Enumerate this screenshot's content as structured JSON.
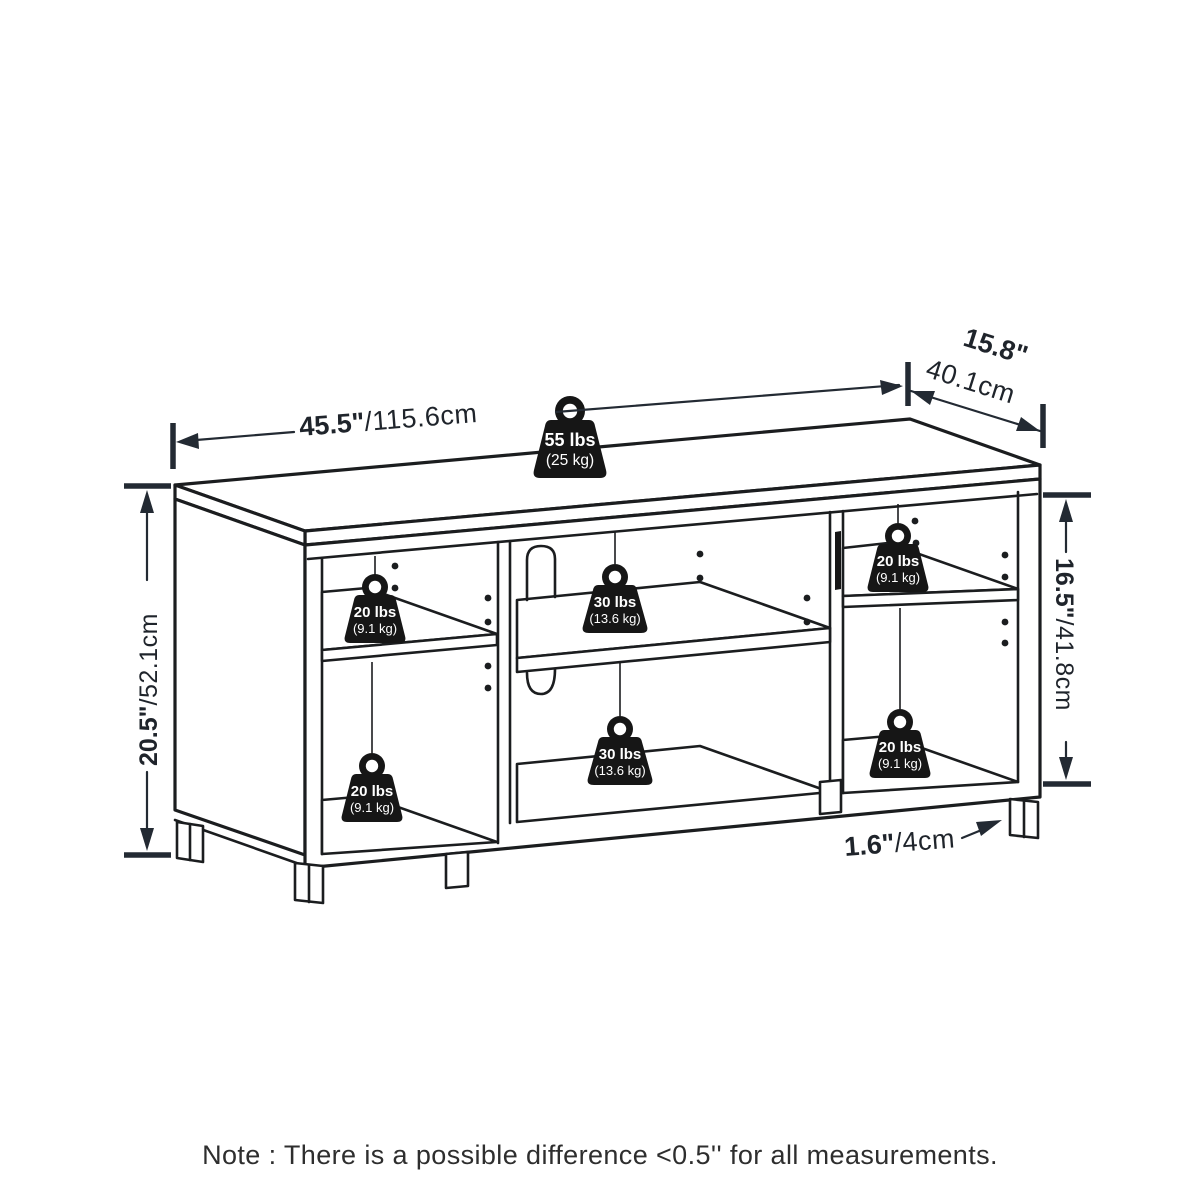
{
  "dimensions": {
    "width": {
      "in": "45.5\"",
      "cm": "/115.6cm"
    },
    "depth": {
      "in": "15.8\"",
      "cm": "40.1cm"
    },
    "height": {
      "in": "20.5\"",
      "cm": "/52.1cm"
    },
    "shelf": {
      "in": "16.5\"",
      "cm": "/41.8cm"
    },
    "leg": {
      "in": "1.6\"",
      "cm": "/4cm"
    }
  },
  "weights": {
    "top": {
      "lbs": "55 lbs",
      "kg": "(25 kg)"
    },
    "shelf30": {
      "lbs": "30 lbs",
      "kg": "(13.6 kg)"
    },
    "shelf20": {
      "lbs": "20 lbs",
      "kg": "(9.1 kg)"
    }
  },
  "note": {
    "text": "Note : There is a possible difference <0.5'' for all measurements."
  },
  "colors": {
    "line": "#1b1d1f",
    "dimension": "#232a33",
    "weight_fill": "#161616",
    "weight_text": "#ffffff",
    "note_text": "#2e2e2e",
    "background": "#ffffff"
  }
}
